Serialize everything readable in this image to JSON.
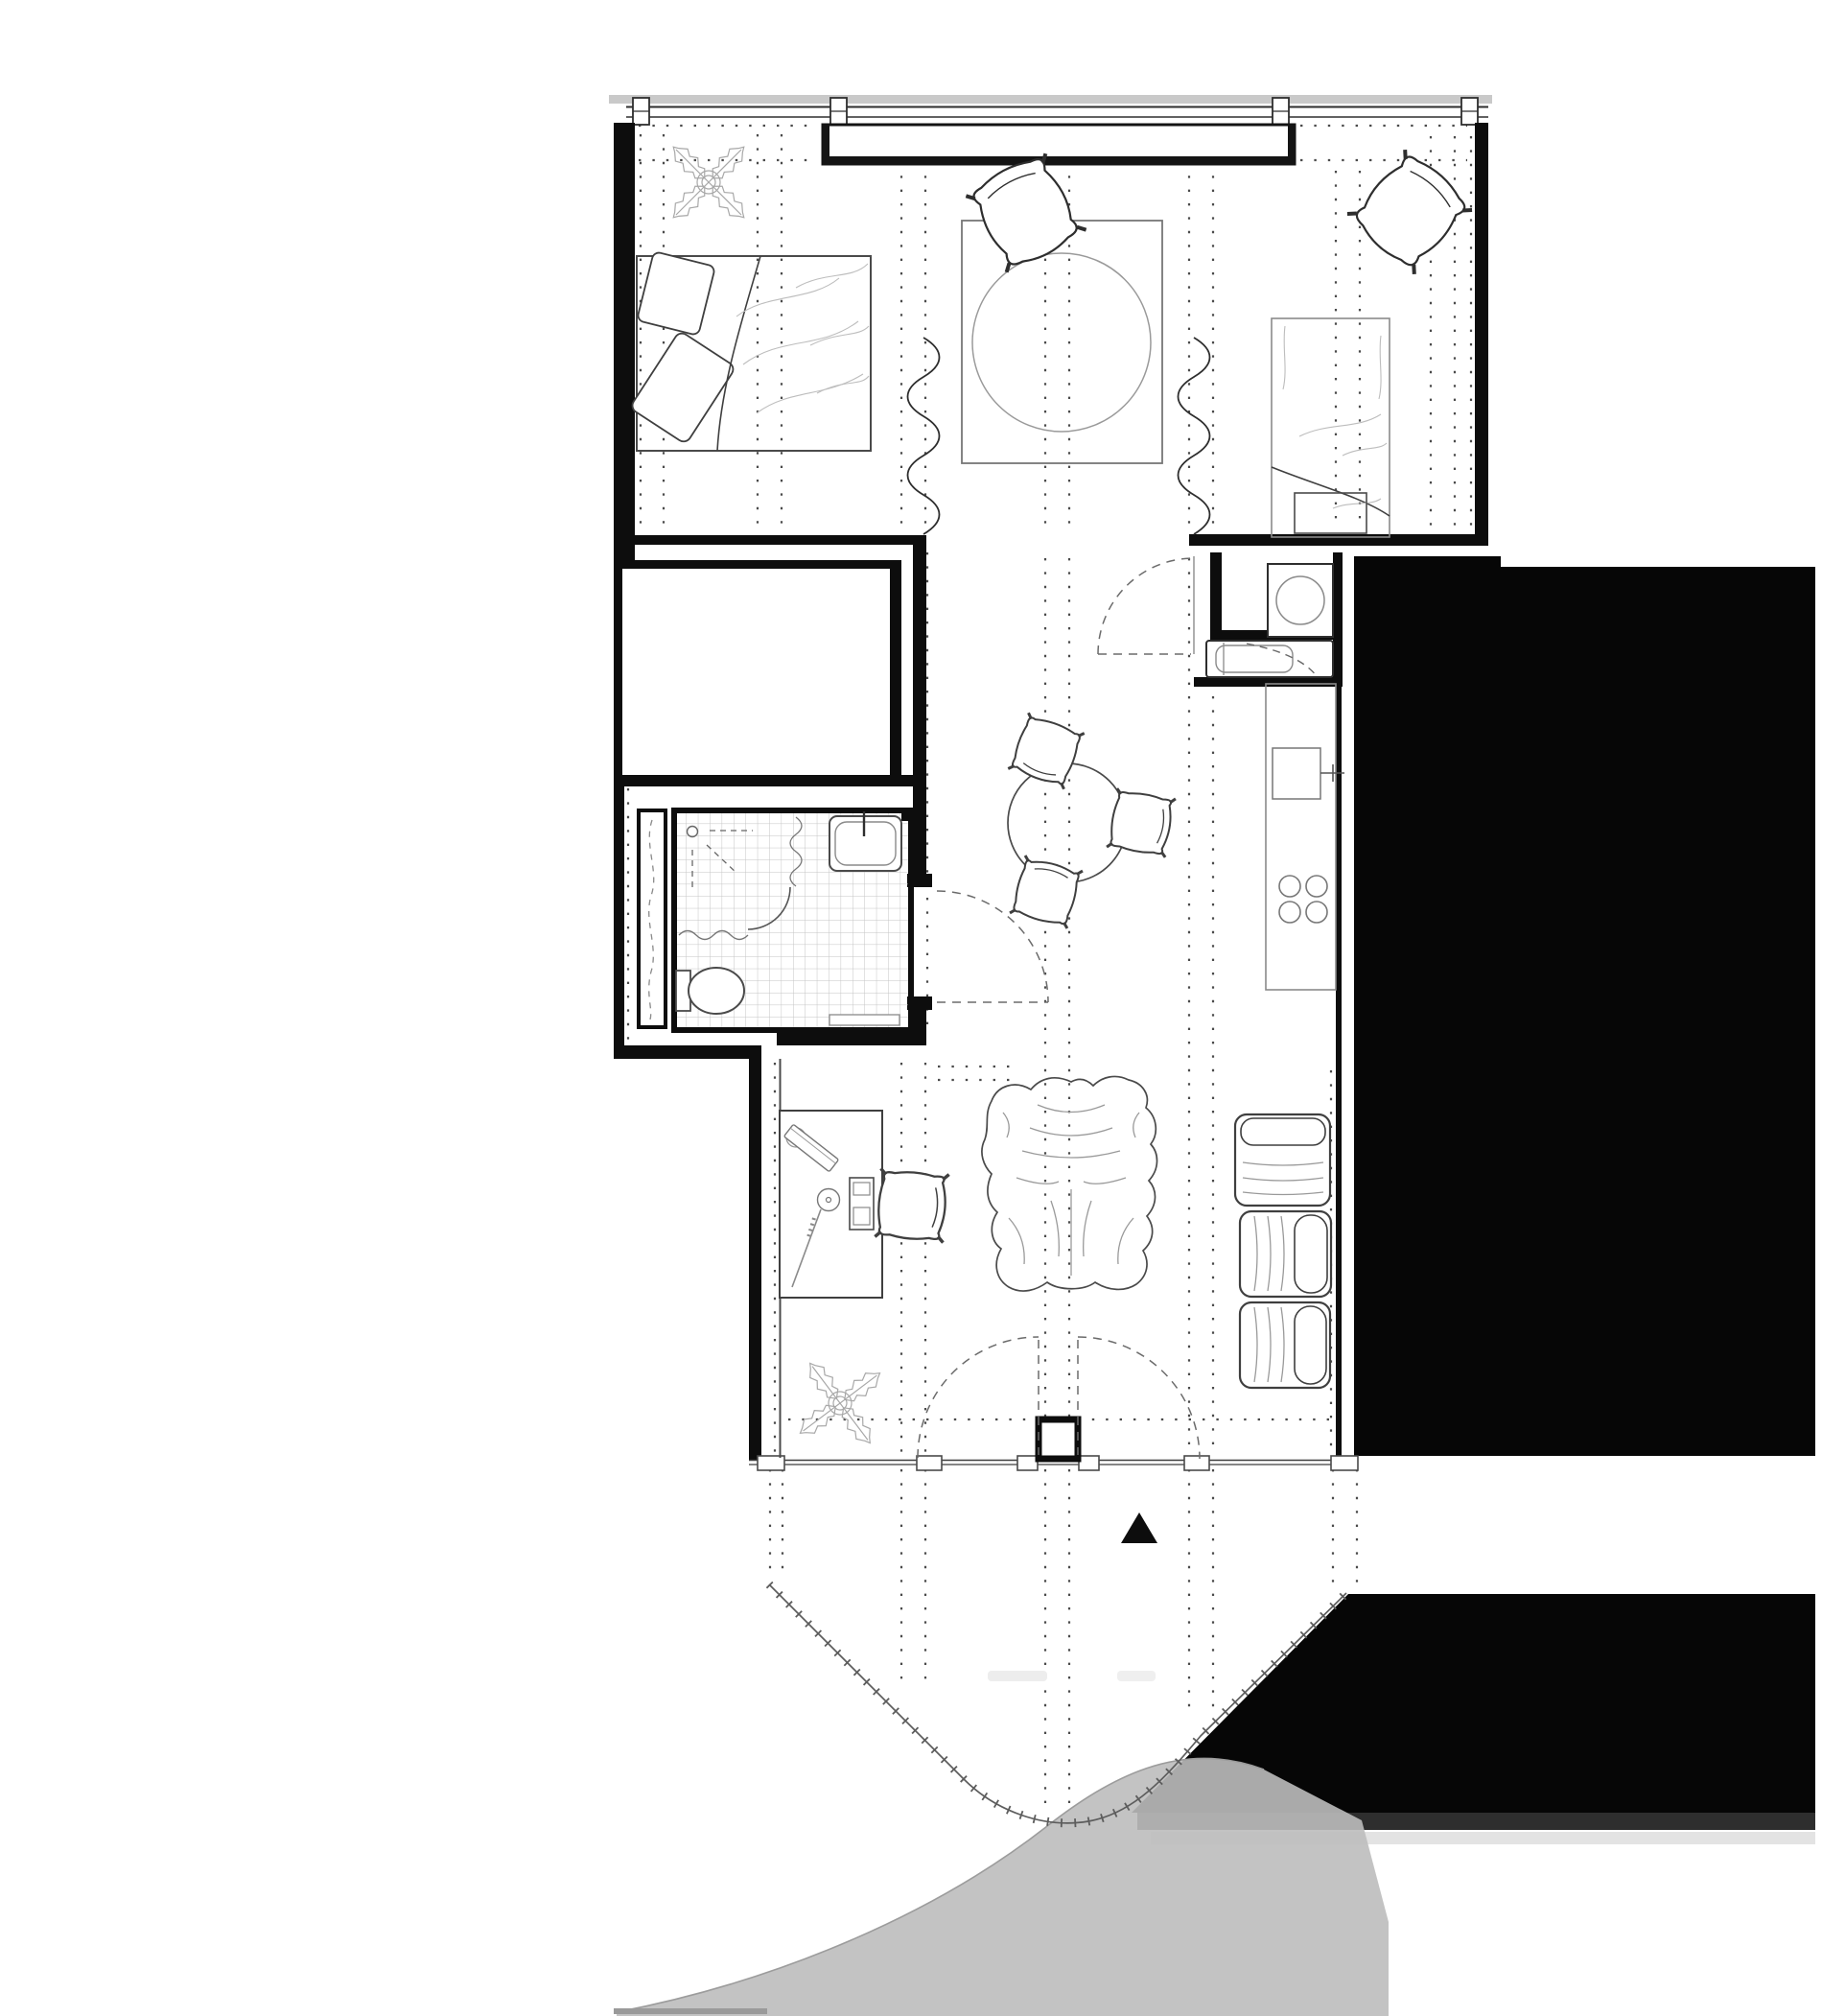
{
  "page": {
    "title": "Studio apartment floor plan",
    "visible_text": [],
    "orientation_marker": "solid-black-triangle"
  },
  "colors": {
    "background": "#ffffff",
    "wall_black": "#0d0d0d",
    "solid_mass": "#060606",
    "mass_dark_band": "#2e2e2e",
    "mass_light_band": "#e3e3e3",
    "window_shading": "#c9c9c9",
    "terrace_shading": "#bdbdbd",
    "terrace_edge": "#a0a0a0",
    "tile_grid": "#c4c4c4",
    "dot_grid": "#4a4a4a",
    "marker": "#0d0d0d"
  },
  "floor_plan": {
    "type": "architectural plan, black and white line drawing",
    "rooms": [
      {
        "id": "sleeping-area",
        "position": "top",
        "furniture": [
          "double-bed-with-pillows",
          "potted-plant",
          "square-rug",
          "round-table",
          "lounge-chair-left",
          "lounge-chair-right",
          "single-bed",
          "foot-bench",
          "wall-closet",
          "curtain-squiggle-left",
          "curtain-squiggle-right"
        ]
      },
      {
        "id": "bathroom",
        "position": "middle-left",
        "fixtures": [
          "tiled-floor",
          "washbasin-with-tap",
          "toilet",
          "shower-head",
          "shower-screen-arc",
          "bath-mat",
          "tall-cabinet"
        ]
      },
      {
        "id": "kitchen-corridor",
        "position": "middle-right",
        "fixtures": [
          "washing-machine-niche",
          "storage-niche-with-sink",
          "kitchen-counter",
          "counter-sink-with-tap",
          "cooktop-four-burners",
          "swing-door"
        ]
      },
      {
        "id": "living-area",
        "position": "lower",
        "furniture": [
          "desk",
          "desk-lamp-and-board",
          "monitor",
          "mouse",
          "desk-chair",
          "animal-hide-rug",
          "dining-table-round",
          "dining-chair-top",
          "dining-chair-right",
          "dining-chair-bottom",
          "sofa-module-1",
          "sofa-module-2",
          "sofa-module-3",
          "potted-plant"
        ]
      },
      {
        "id": "terrace",
        "position": "bottom",
        "features": [
          "double-swing-door",
          "door-pillar",
          "window-mullions",
          "ticked-railing-curve",
          "outer-curved-edge",
          "orientation-triangle"
        ]
      }
    ],
    "adjacent_solid_masses": 2,
    "cooktop_burners": 4,
    "sofa_modules": 3,
    "dining_chairs": 3
  }
}
